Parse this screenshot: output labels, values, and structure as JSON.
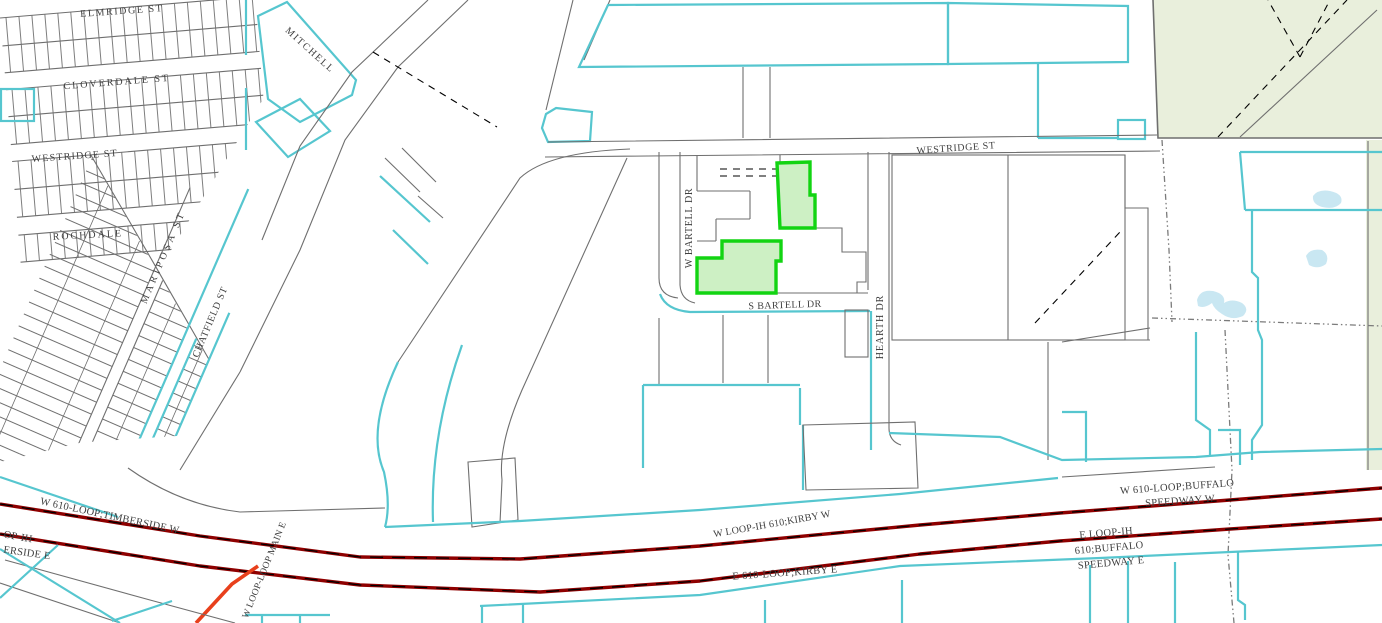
{
  "map": {
    "street_labels": {
      "elmridge": "ELMRIDGE ST",
      "cloverdale": "CLOVERDALE ST",
      "westridge_w": "WESTRIDGE ST",
      "rochdale": "ROCHDALE",
      "mariposa": "MARIPOSA ST",
      "chatfield": "CHATFIELD ST",
      "mitchell": "MITCHELL",
      "westridge": "WESTRIDGE ST",
      "w_bartell": "W BARTELL DR",
      "s_bartell": "S BARTELL DR",
      "hearth": "HEARTH DR"
    },
    "highway_labels": {
      "timberside_w": "W 610-LOOP;TIMBERSIDE W",
      "timberside_e_frag_top": "OP-IH",
      "timberside_e_frag_bottom": "ERSIDE E",
      "kirby_w": "W LOOP-IH 610;KIRBY W",
      "kirby_e": "E 610-LOOP;KIRBY E",
      "buffalo_w_1": "W 610-LOOP;BUFFALO",
      "buffalo_w_2": "SPEEDWAY W",
      "buffalo_e_1": "E LOOP-IH",
      "buffalo_e_2": "610;BUFFALO",
      "buffalo_e_3": "SPEEDWAY E",
      "loop_main": "W LOOP-LOOP MAIN E"
    },
    "theme": {
      "background": "#ffffff",
      "parcel_line": "#6f6f6f",
      "water_line": "#56c6cf",
      "water_fill": "#c9e7f2",
      "highway": "#8e0000",
      "ramp": "#e8401c",
      "selected_stroke": "#12d412",
      "selected_fill": "#cdf0c4",
      "zone_fill": "#e9efdc",
      "boundary": "#7b7b7b",
      "label": "#3f3f3f"
    }
  }
}
